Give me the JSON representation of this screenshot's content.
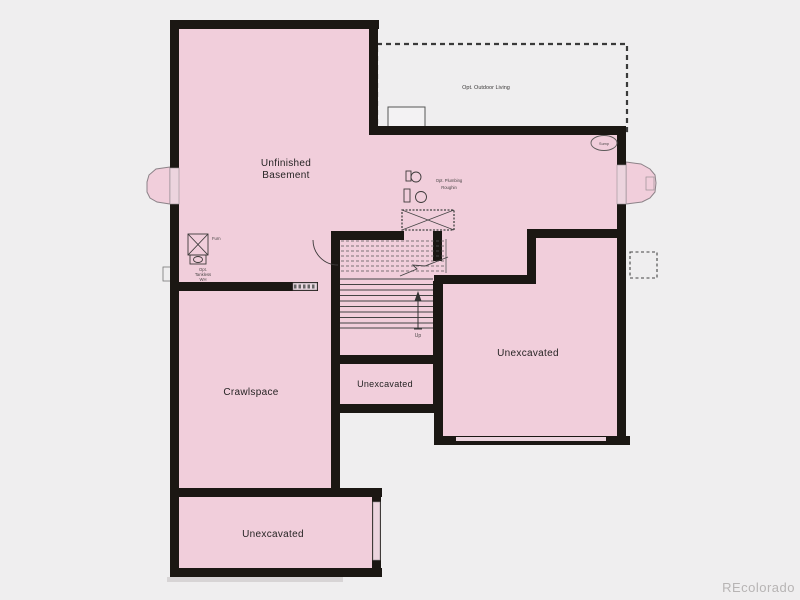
{
  "colors": {
    "background": "#efeeef",
    "floor": "#f1cedb",
    "wall": "#1b1713",
    "floor_light": "#ecd4de",
    "line": "#444444",
    "watermark_color": "#b7b4b4"
  },
  "labels": {
    "unfinished_basement_line1": "Unfinished",
    "unfinished_basement_line2": "Basement",
    "crawlspace": "Crawlspace",
    "unexcavated_right": "Unexcavated",
    "unexcavated_middle": "Unexcavated",
    "unexcavated_bottom": "Unexcavated",
    "opt_outdoor_living": "Opt. Outdoor Living",
    "opt_plumbing_line1": "Opt. Plumbing",
    "opt_plumbing_line2": "Roughin",
    "sump": "Sump",
    "furnace": "Furn",
    "opt_tankless_line1": "Opt.",
    "opt_tankless_line2": "Tankless",
    "opt_tankless_line3": "WH",
    "stairs_up": "Up",
    "watermark": "REcolorado"
  }
}
